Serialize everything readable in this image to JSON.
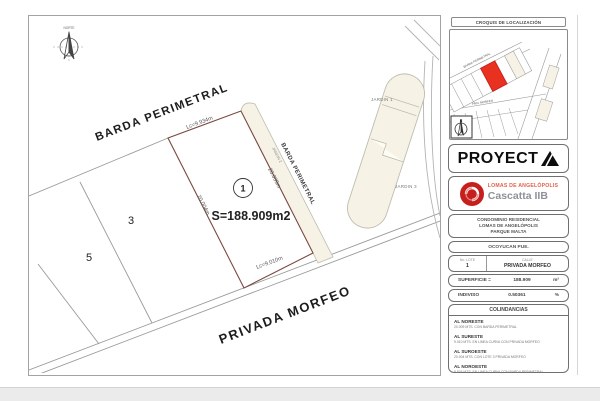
{
  "plan": {
    "north_label": "NORTE",
    "street_barda_top": "BARDA PERIMETRAL",
    "street_barda_side": "BARDA PERIMETRAL",
    "street_privada": "PRIVADA MORFEO",
    "lot1_number": "1",
    "lot3_number": "3",
    "lot5_number": "5",
    "area_label": "S=188.909m2",
    "dim_top": "Lc=9.934m",
    "dim_left": "20.004m",
    "dim_right": "20.009m",
    "dim_bottom": "Lc=9.010m",
    "jardin1": "JARDIN 1",
    "jardin2": "JARDIN 2",
    "jardin3": "JARDIN 3",
    "colors": {
      "lot_outline": "#7b4a42",
      "garden_fill": "#f6f3e6",
      "line_gray": "#9a9a9a",
      "highlight_red": "#e8311f"
    }
  },
  "panel": {
    "croquis": {
      "title": "CROQUIS DE LOCALIZACIÓN",
      "street1": "BARDA PERIMETRAL",
      "street2": "PRIV. MORFEO",
      "north_letter": "N"
    },
    "proyecta": {
      "brand_full": "PROYECTA",
      "brand_text": "PROYECT"
    },
    "cascatta": {
      "line1": "LOMAS DE ANGELÓPOLIS",
      "line2": "Cascatta IIB",
      "logo_color": "#c5201e"
    },
    "condominio": {
      "line1": "CONDOMINIO RESIDENCIAL",
      "line2": "LOMAS DE ANGELÓPOLIS",
      "line3": "PARQUE MALTA"
    },
    "municipio": "OCOYUCAN PUE.",
    "lot_table": {
      "col1_header": "No. LOTE",
      "col1_value": "1",
      "col2_header": "CALLE",
      "col2_value": "PRIVADA MORFEO"
    },
    "superficie": {
      "label": "SUPERFICIE =",
      "value": "188.909",
      "unit": "m²"
    },
    "indiviso": {
      "label": "INDIVISO",
      "value": "0.50361",
      "unit": "%"
    },
    "colindancias": {
      "title": "COLINDANCIAS",
      "items": [
        {
          "heading": "AL NORESTE",
          "detail": "20.009 MTS. CON BARDA PERIMETRAL"
        },
        {
          "heading": "AL SURESTE",
          "detail": "9.010 MTS. EN LINEA CURVA CON PRIVADA MORFEO"
        },
        {
          "heading": "AL SUROESTE",
          "detail": "20.004 MTS. CON LOTE 3 PRIVADA MORFEO"
        },
        {
          "heading": "AL NOROESTE",
          "detail": "9.934 MTS. EN LINEA CURVA CON BARDA PERIMETRAL"
        }
      ]
    }
  }
}
